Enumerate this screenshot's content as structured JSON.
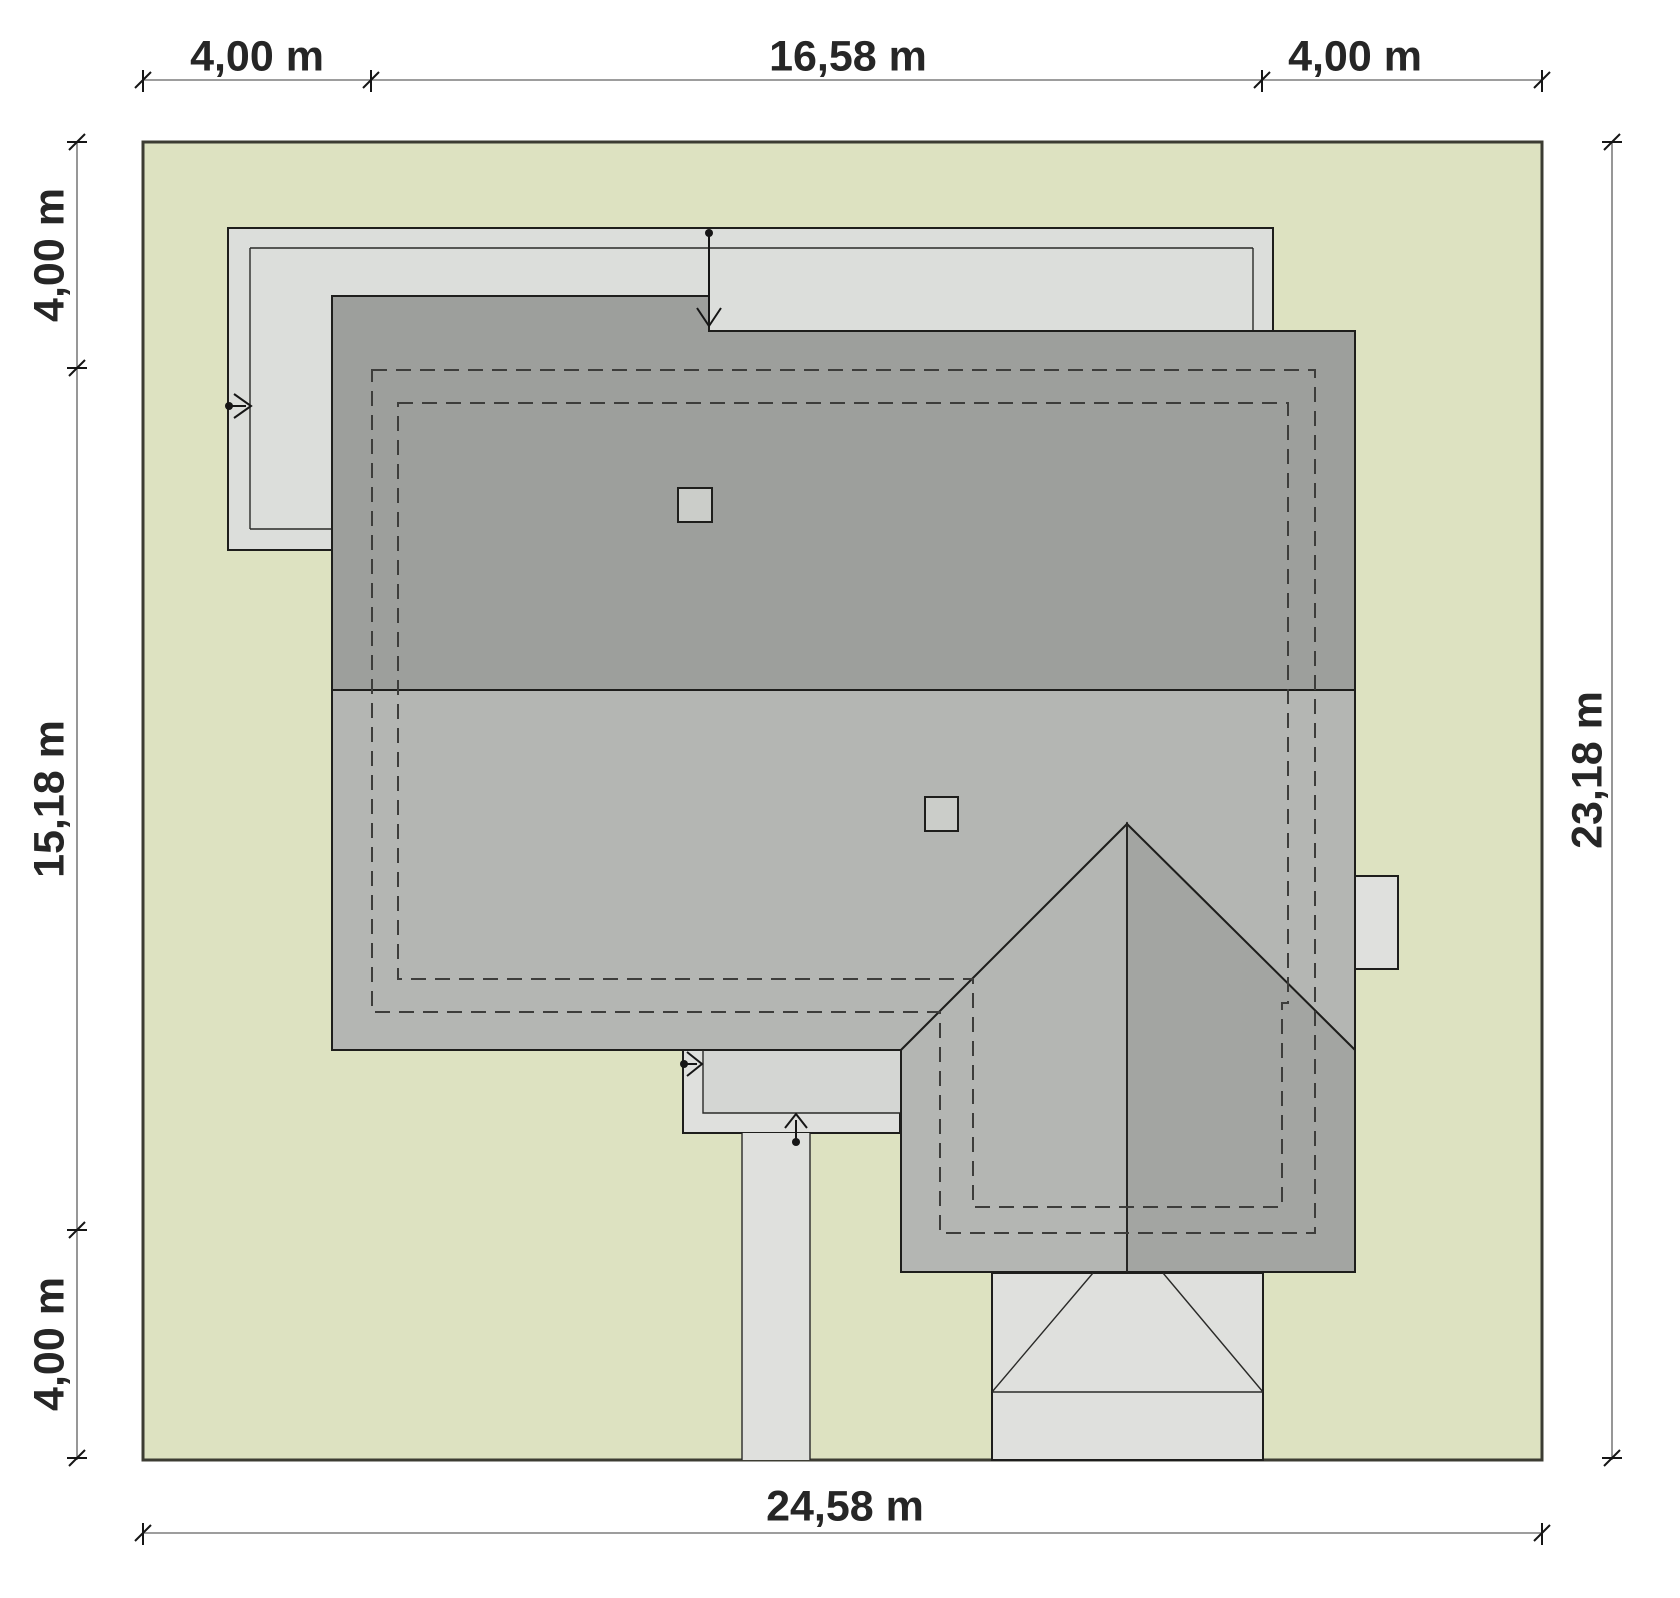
{
  "dimensions": {
    "top": [
      "4,00 m",
      "16,58 m",
      "4,00 m"
    ],
    "left": [
      "4,00 m",
      "15,18 m",
      "4,00 m"
    ],
    "right": [
      "23,18 m"
    ],
    "bottom": [
      "24,58 m"
    ]
  },
  "colors": {
    "plot": "#dde2c1",
    "band": "#dcdedb",
    "roof_dark": "#9d9f9c",
    "roof_light": "#b4b6b3",
    "gable_right": "#a3a5a2",
    "paving": "#dfe0dd",
    "paving_dark": "#d4d6d3",
    "chimney": "#cbcdc9",
    "dimension_text": "#262626"
  }
}
